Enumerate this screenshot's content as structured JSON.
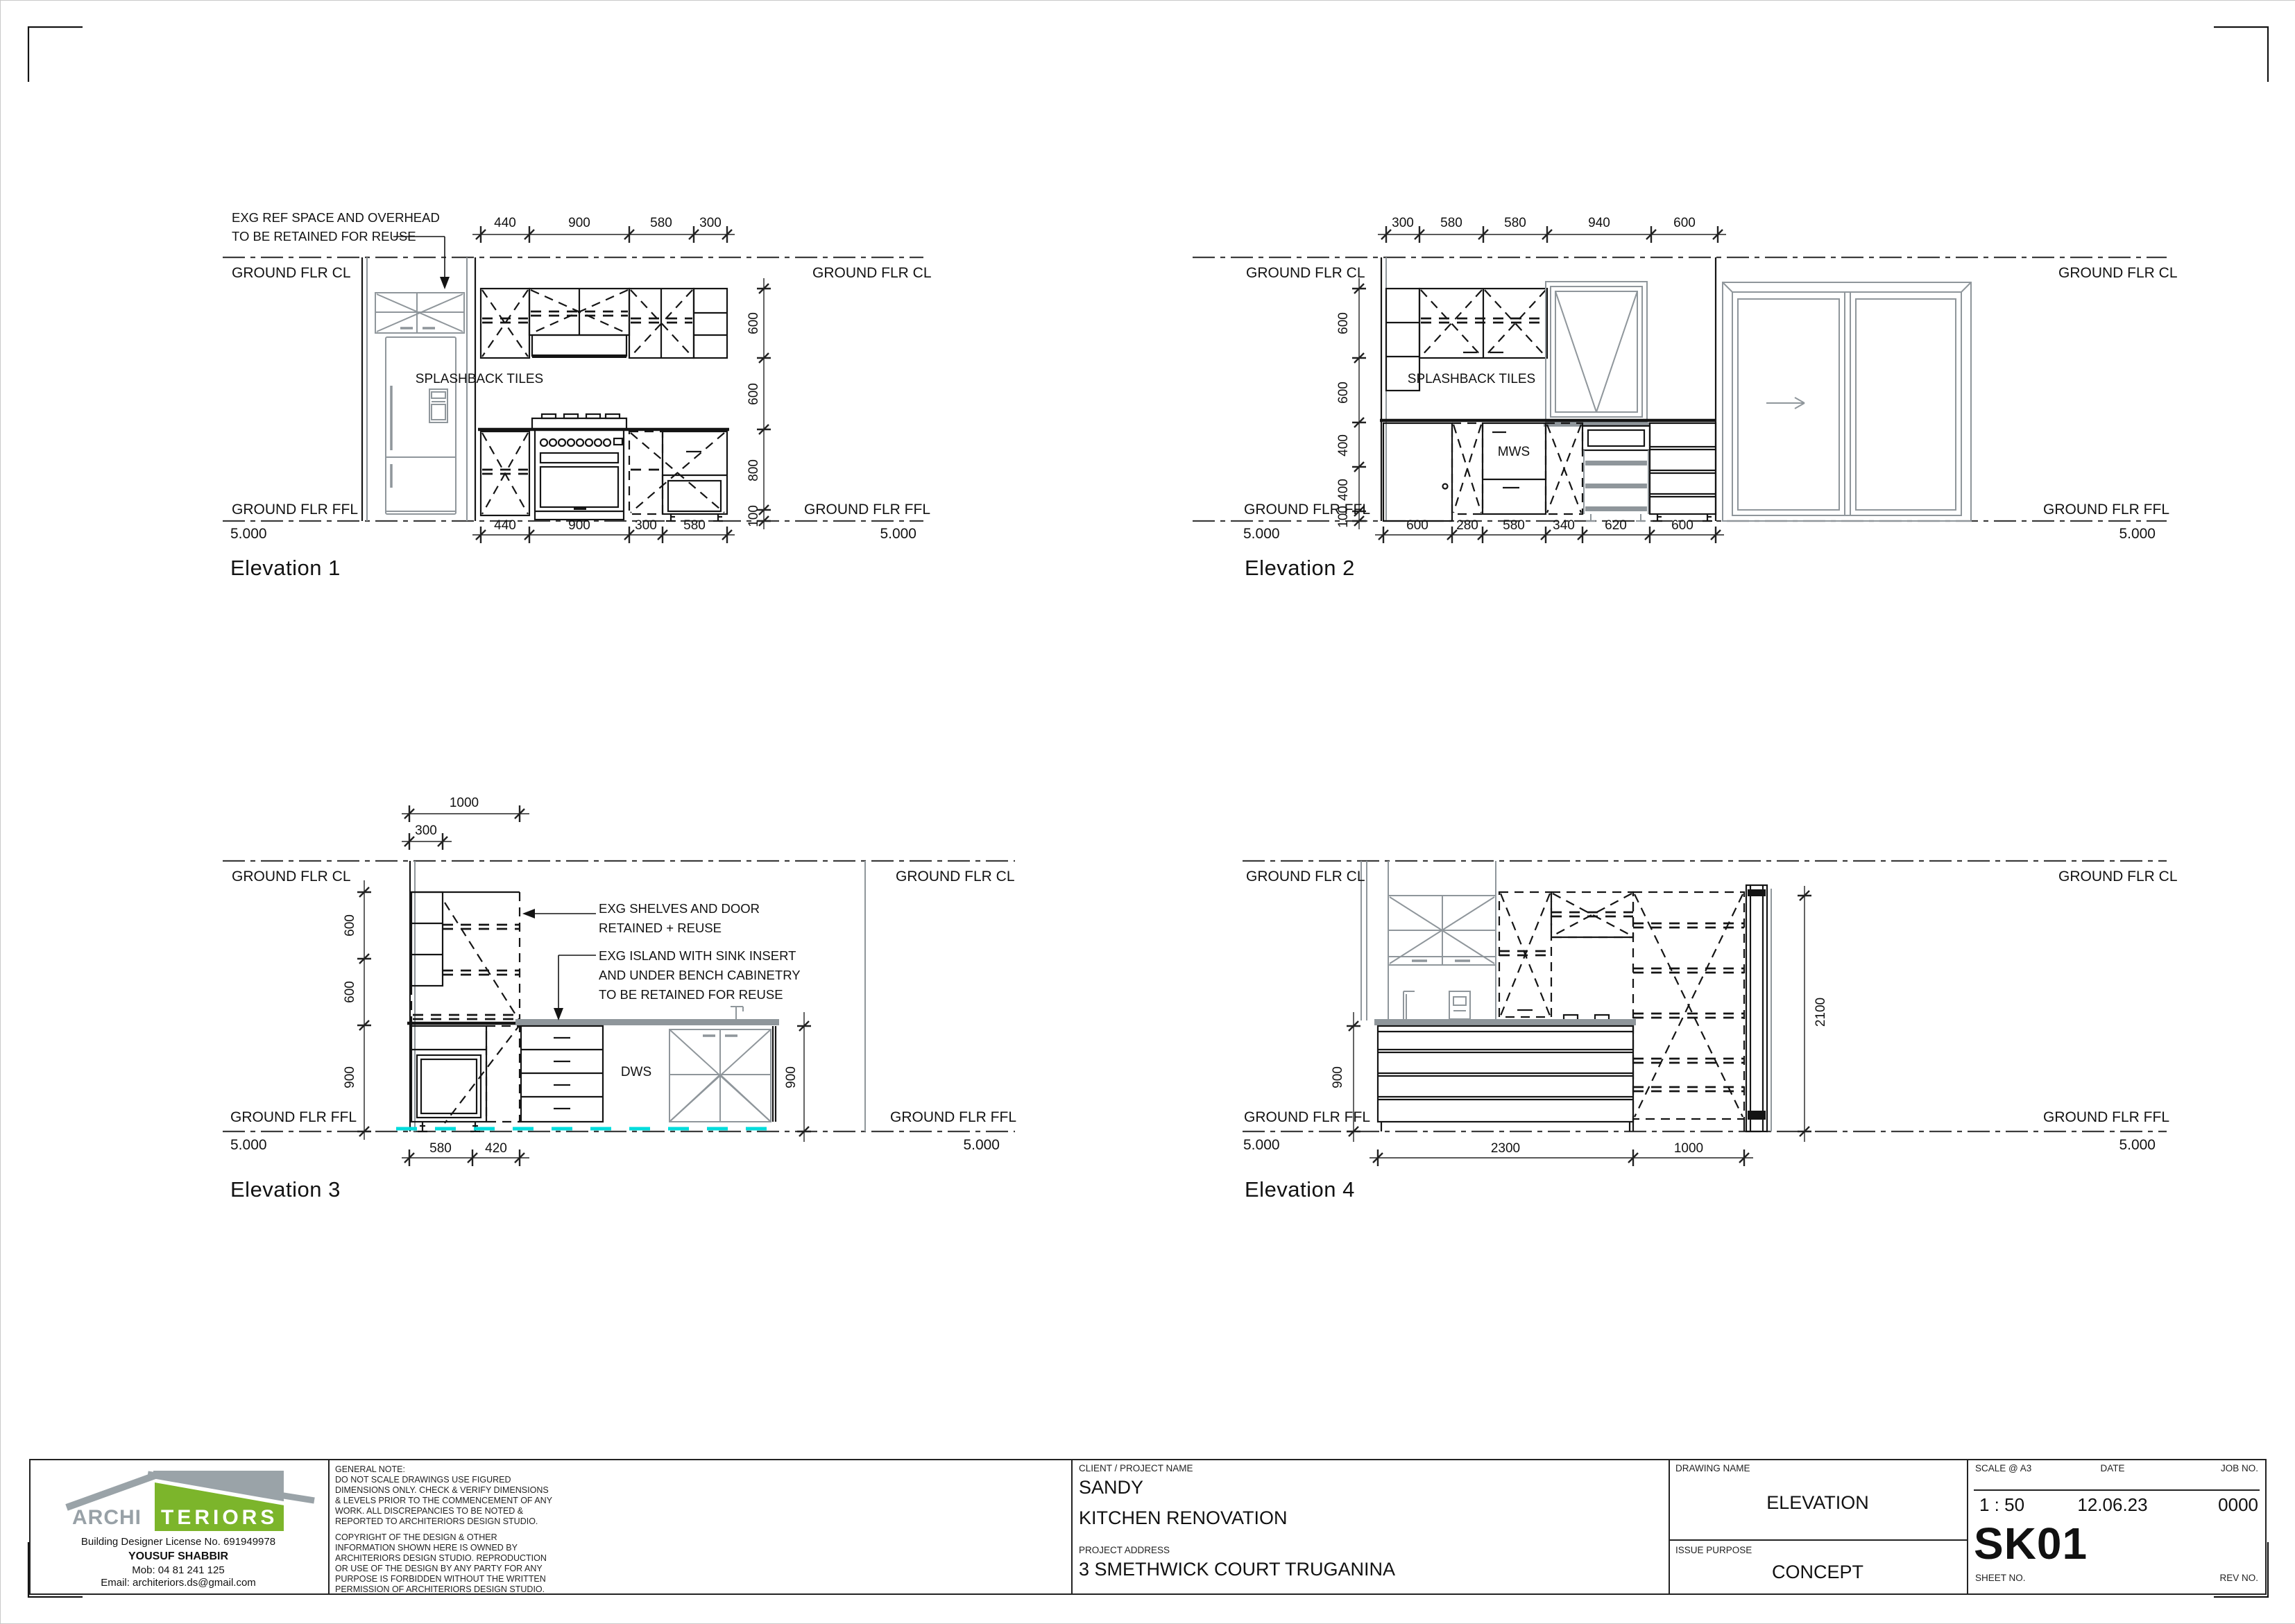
{
  "levels": {
    "cl": "GROUND FLR CL",
    "ffl": "GROUND FLR FFL",
    "datum": "5.000"
  },
  "elev1": {
    "title": "Elevation 1",
    "note": [
      "EXG REF SPACE AND OVERHEAD",
      "TO BE RETAINED FOR REUSE"
    ],
    "splashback": "SPLASHBACK TILES",
    "top_dims": [
      "440",
      "900",
      "580",
      "300"
    ],
    "bottom_dims": [
      "440",
      "900",
      "300",
      "580"
    ],
    "side_dims": [
      "600",
      "600",
      "800",
      "100"
    ]
  },
  "elev2": {
    "title": "Elevation 2",
    "splashback": "SPLASHBACK TILES",
    "mws": "MWS",
    "top_dims": [
      "300",
      "580",
      "580",
      "940",
      "600"
    ],
    "bottom_dims": [
      "600",
      "280",
      "580",
      "340",
      "620",
      "600"
    ],
    "side_dims": [
      "600",
      "600",
      "400",
      "400",
      "100"
    ]
  },
  "elev3": {
    "title": "Elevation 3",
    "dws": "DWS",
    "dim_1000": "1000",
    "dim_300": "300",
    "side_dims": [
      "600",
      "600",
      "900"
    ],
    "right_dim": "900",
    "bottom_dims": [
      "580",
      "420"
    ],
    "note_shelves": [
      "EXG SHELVES AND DOOR",
      "RETAINED + REUSE"
    ],
    "note_island": [
      "EXG ISLAND WITH SINK INSERT",
      "AND UNDER BENCH CABINETRY",
      "TO BE RETAINED FOR REUSE"
    ]
  },
  "elev4": {
    "title": "Elevation 4",
    "left_dim": "900",
    "right_dim": "2100",
    "bottom_dims": [
      "2300",
      "1000"
    ]
  },
  "title_block": {
    "logo_archi": "ARCHI",
    "logo_teriors": "TERIORS",
    "license": "Building Designer License No. 691949978",
    "designer": "YOUSUF SHABBIR",
    "mobile": "Mob:  04 81 241 125",
    "email": "Email: architeriors.ds@gmail.com",
    "general_note_lines": [
      "GENERAL NOTE:",
      "DO NOT SCALE DRAWINGS USE FIGURED",
      "DIMENSIONS ONLY. CHECK & VERIFY DIMENSIONS",
      "& LEVELS PRIOR TO THE COMMENCEMENT OF ANY",
      "WORK. ALL DISCREPANCIES TO BE NOTED &",
      "REPORTED TO ARCHITERIORS DESIGN STUDIO."
    ],
    "copyright_lines": [
      "COPYRIGHT OF THE DESIGN & OTHER",
      "INFORMATION SHOWN HERE IS OWNED BY",
      "ARCHITERIORS DESIGN STUDIO. REPRODUCTION",
      "OR USE OF THE DESIGN BY ANY PARTY FOR ANY",
      "PURPOSE IS FORBIDDEN WITHOUT THE WRITTEN",
      "PERMISSION OF ARCHITERIORS DESIGN STUDIO."
    ],
    "client_label": "CLIENT / PROJECT NAME",
    "client": "SANDY",
    "project": "KITCHEN RENOVATION",
    "address_label": "PROJECT ADDRESS",
    "address": "3 SMETHWICK COURT TRUGANINA",
    "drawing_name_label": "DRAWING NAME",
    "drawing_name": "ELEVATION",
    "issue_label": "ISSUE PURPOSE",
    "issue": "CONCEPT",
    "scale_label": "SCALE @ A3",
    "scale": "1 : 50",
    "date_label": "DATE",
    "date": "12.06.23",
    "job_label": "JOB NO.",
    "job": "0000",
    "sheet_no": "SK01",
    "sheet_label": "SHEET NO.",
    "rev_label": "REV NO."
  },
  "colors": {
    "cad_black": "#141414",
    "existing_gray": "#8f969b",
    "floor_cyan": "#00dcdc",
    "logo_green": "#7cb52b",
    "logo_gray": "#9aa3a8"
  }
}
